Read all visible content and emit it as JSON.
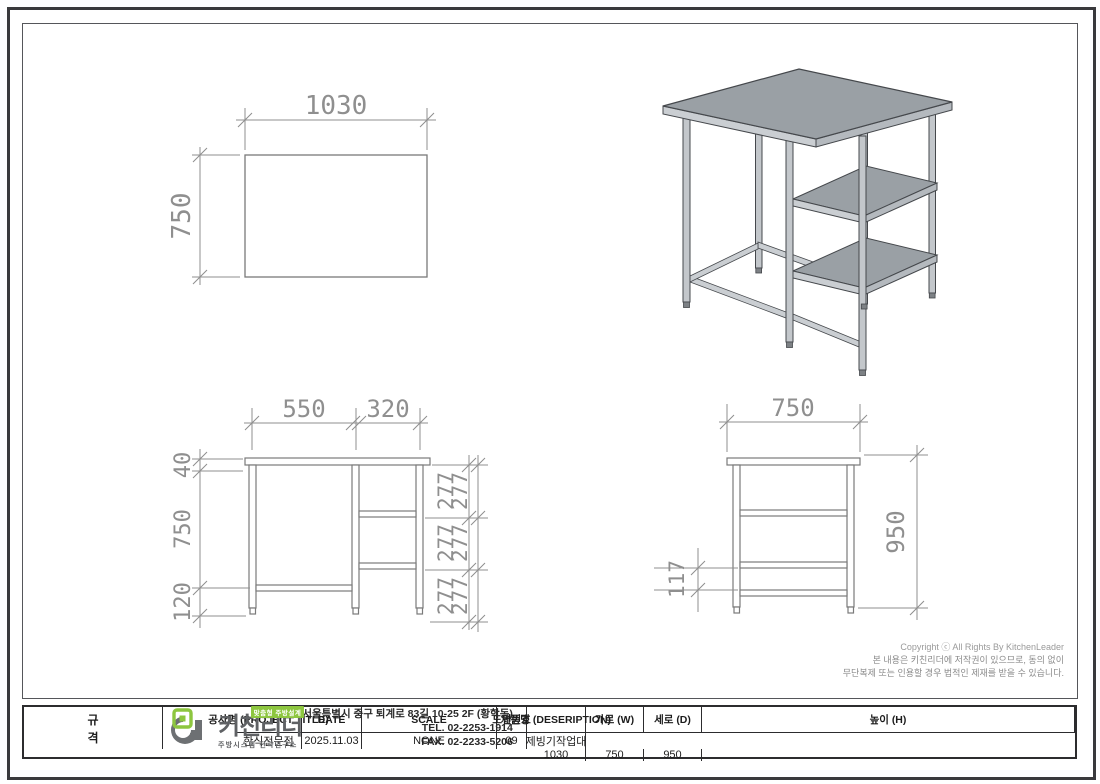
{
  "page": {
    "background": "#ffffff",
    "border_color": "#3a3a3c",
    "line_color": "#7a7a7a",
    "dim_color": "#8f8f8f"
  },
  "views": {
    "plan": {
      "width": "1030",
      "depth": "750"
    },
    "front": {
      "top_left": "550",
      "top_right": "320",
      "thickness": "40",
      "height": "750",
      "bottom": "120",
      "shelf": "277"
    },
    "side": {
      "depth": "750",
      "height": "950",
      "gap": "117"
    },
    "iso": {
      "top_color": "#9aa0a5",
      "edge_color": "#caced2",
      "side_color": "#b4b9be",
      "leg_color": "#c3c7cb",
      "outline_color": "#45484c"
    }
  },
  "copyright": {
    "line1": "Copyright ⓒ All Rights By KitchenLeader",
    "line2": "본 내용은 키친리더에 저작권이 있으므로, 동의 없이",
    "line3": "무단복제 또는 인용할 경우 법적인 제재를 받을 수 있습니다."
  },
  "title_block": {
    "project": {
      "label": "공사명 (PROJECT TITLE)",
      "value": "한식전문점"
    },
    "date": {
      "label": "DATE",
      "value": "2025.11.03"
    },
    "scale": {
      "label": "SCALE",
      "value": "NONE"
    },
    "drawing_no": {
      "label": "도면번호",
      "value": "09"
    },
    "product": {
      "label": "제품명 (DESERIPTION)",
      "value": "제빙기작업대"
    },
    "spec": {
      "top": "규",
      "bottom": "격"
    },
    "width": {
      "label": "가로 (W)",
      "value": "1030"
    },
    "depth": {
      "label": "세로 (D)",
      "value": "750"
    },
    "height": {
      "label": "높이 (H)",
      "value": "950"
    }
  },
  "brand": {
    "badge": "맞춤형 주방설계",
    "name": "키친리더",
    "subtitle": "주방시스템 전략연구소",
    "address": "서울특별시 중구 퇴계로 83길 10-25 2F (황학동)",
    "tel": "TEL. 02-2253-1914",
    "fax": "FAX. 02-2233-5206",
    "green": "#8dc63f",
    "gray": "#5f6164"
  }
}
